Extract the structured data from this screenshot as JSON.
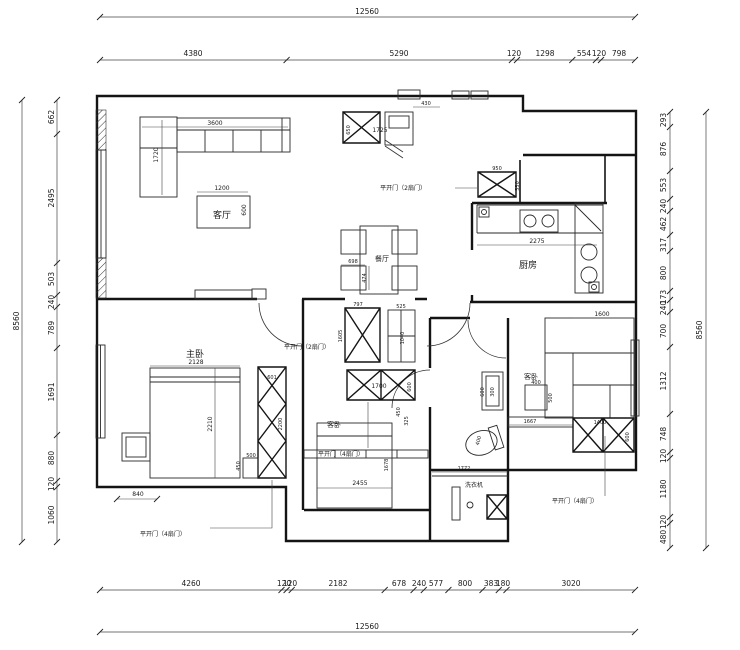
{
  "dims": {
    "top": {
      "overall": "12560",
      "segments": [
        "4380",
        "5290",
        "120",
        "1298",
        "554",
        "120",
        "798"
      ]
    },
    "bottom": {
      "overall": "12560",
      "segments": [
        "4260",
        "120",
        "120",
        "2182",
        "678",
        "240",
        "577",
        "800",
        "383",
        "180",
        "3020"
      ]
    },
    "left": {
      "overall": "8560",
      "segments": [
        "662",
        "2495",
        "503",
        "240",
        "789",
        "1691",
        "880",
        "120",
        "1060"
      ]
    },
    "right": {
      "overall": "8560",
      "segments": [
        "293",
        "876",
        "553",
        "240",
        "462",
        "317",
        "800",
        "173",
        "240",
        "700",
        "1312",
        "748",
        "120",
        "1180",
        "120",
        "480"
      ]
    }
  },
  "rooms": {
    "living": "客厅",
    "master": "主卧",
    "dining": "餐厅",
    "kitchen": "厨房",
    "guest_center": "客卧",
    "guest_right": "客卧"
  },
  "labels": {
    "washing_machine": "洗衣机",
    "door2": "平开门（2扇门）",
    "door4": "平开门（4扇门）"
  },
  "f": {
    "sofa_w": "3600",
    "sofa_d": "1720",
    "table_w": "1200",
    "table_d": "600",
    "entry_d": "650",
    "entry_w": "1725",
    "top430": "430",
    "cab950": "950",
    "cab550": "550",
    "counter": "2275",
    "din_w": "698",
    "din_d": "474",
    "c797": "797",
    "c1605": "1605",
    "c525": "525",
    "c1040": "1040",
    "ward_w": "1700",
    "ward_d": "600",
    "bed_c_l": "2455",
    "bed_c_d": "1678",
    "s450": "450",
    "s325": "325",
    "mbed_w": "2128",
    "mbed_l": "2210",
    "mward_w": "601",
    "mward_l": "2200",
    "m500": "500",
    "m450": "450",
    "m840": "840",
    "toilet": "400",
    "laundry": "1772",
    "bath_a": "600",
    "bath_b": "300",
    "side_w": "400",
    "side_d": "500",
    "rbed": "1600",
    "bench": "1667",
    "rward": "1400",
    "rward_d": "600"
  },
  "colors": {
    "line": "#141414",
    "bg": "#ffffff"
  }
}
